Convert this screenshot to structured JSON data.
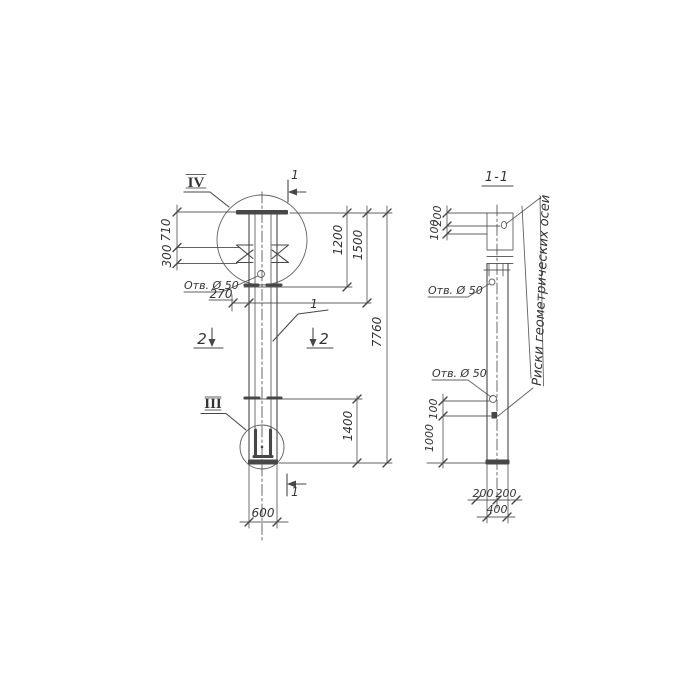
{
  "colors": {
    "ink": "#474747",
    "paper": "#ffffff"
  },
  "front_view": {
    "detail_top": "IV",
    "detail_bottom": "III",
    "cut_1_top": "1",
    "cut_1_bottom": "1",
    "cut_2_left": "2",
    "cut_2_right": "2",
    "part_callout": "1",
    "hole_label": "Отв. Ø 50",
    "dim_710": "710",
    "dim_300": "300",
    "dim_270": "270",
    "dim_1200": "1200",
    "dim_1500": "1500",
    "dim_7760": "7760",
    "dim_1400": "1400",
    "dim_600": "600"
  },
  "section_view": {
    "title": "1-1",
    "hole_label_upper": "Отв. Ø 50",
    "hole_label_lower": "Отв. Ø 50",
    "axes_note": "Риски геометрических осей",
    "dim_200_top": "200",
    "dim_100_upper": "100",
    "dim_100_lower": "100",
    "dim_1000": "1000",
    "dim_200_left": "200",
    "dim_200_right": "200",
    "dim_400": "400"
  }
}
